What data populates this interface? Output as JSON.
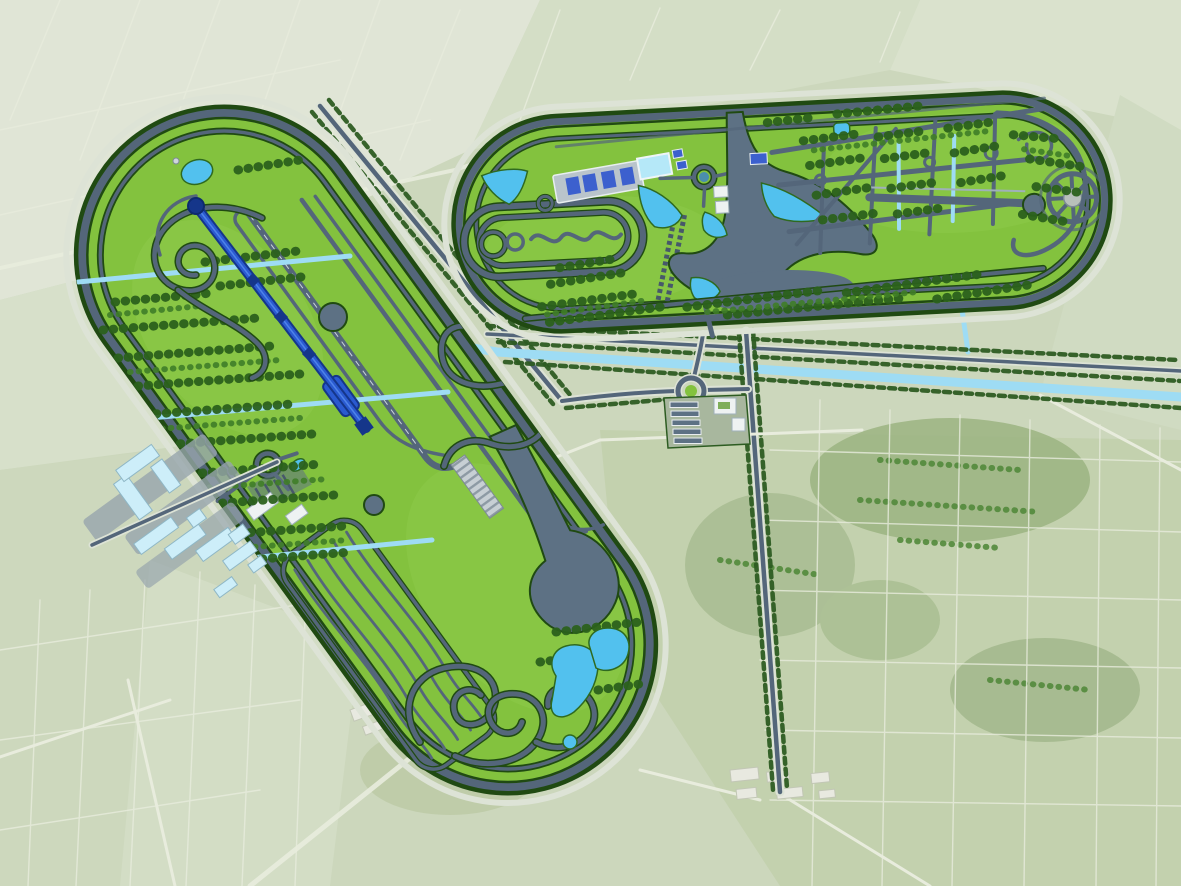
{
  "meta": {
    "scene": "Aerial rendering of a vehicle proving-ground master plan over flat farmland",
    "aria_label": "Aerial site plan showing two stadium-shaped test track facilities, an R&D campus, a gate complex, tree-lined roads and canals across pale green farmland",
    "image_type": "rendered masterplan over satellite imagery",
    "visible_text": "none"
  },
  "colors": {
    "farmland_base": "#ccd7bc",
    "farmland_pale": "#e0e5d6",
    "farmland_light": "#d4dec6",
    "farmland_dark": "#b7c9a4",
    "woods": "#9cb482",
    "park_green": "#83c23e",
    "park_light": "#95cf52",
    "track_gray": "#54667a",
    "track_edge_green": "#204a12",
    "pavement": "#5d7184",
    "tree_dark": "#2b611c",
    "tree_light": "#3f7d28",
    "water_blue": "#52c1ee",
    "water_light": "#9edcf4",
    "canal_blue": "#7fd2f2",
    "speed_track_blue": "#2a5ad0",
    "speed_track_dark": "#15368a",
    "roof_glass": "#cdeef9",
    "roof_solar": "#3c60ce",
    "building_white": "#eef2f2"
  },
  "west_facility": {
    "name": "west proving ground",
    "shape": "stadium oval, long axis rotated about -36 degrees",
    "speed_straight_nodes": 3,
    "durability_lanes": 5,
    "features": [
      "high-speed perimeter ring",
      "inner service ring",
      "blue wet-braking straight with turnaround circle, three node pads and end basin",
      "parallel acceleration straights",
      "winding handling course",
      "hairpin loop cluster",
      "skid circle",
      "durability wavy-lane field",
      "striped special-surface strip",
      "teardrop paved pad",
      "south serpentine course",
      "three cross irrigation channels",
      "tree plantation rows",
      "north pond with mast",
      "workshop roundabout and buildings",
      "south teardrop pond and twin ponds"
    ]
  },
  "north_facility": {
    "name": "north proving ground",
    "shape": "stadium oval, long axis rotated about -3 degrees",
    "solar_bays": 4,
    "wheel_spokes": 8,
    "features": [
      "high-speed perimeter ring",
      "inner service ring",
      "west inner circuit with twin skid circles and serpentine",
      "solar-roof workshop row",
      "rectangular water basin pool",
      "west triangular pond",
      "two roundabouts",
      "diagonal parking rows",
      "fan-shaped vehicle dynamics platform",
      "four retention ponds",
      "city street grid with tree blocks",
      "two grid water channels",
      "drag strip with turnaround bulb",
      "radial spoke intersection wheel",
      "northeast cap loop road",
      "south tree band"
    ]
  },
  "campus": {
    "name": "R&D campus",
    "buildings": 11,
    "roof_style": "glass-blue roofs on white blocks",
    "access": "diagonal access road leading into the west oval roundabout"
  },
  "gate_complex": {
    "name": "main gate complex",
    "parking_rows": 5,
    "buildings": 2,
    "roundabout": "tree-ringed roundabout west of the gate"
  },
  "infrastructure": {
    "roads": [
      "northwest diagonal tree-lined approach road",
      "east-west gate road",
      "southbound tree-lined avenue",
      "south corridor road along north oval"
    ],
    "canals": [
      "main east-west canal south of the north oval",
      "short vertical canal connector",
      "three cross channels inside the west oval"
    ]
  },
  "landscape": {
    "field_regions": [
      "pale stubble fields northwest",
      "striped crop fields north and east",
      "dark wooded patches southeast",
      "strip fields southwest",
      "village clusters south"
    ],
    "villages": 2
  }
}
